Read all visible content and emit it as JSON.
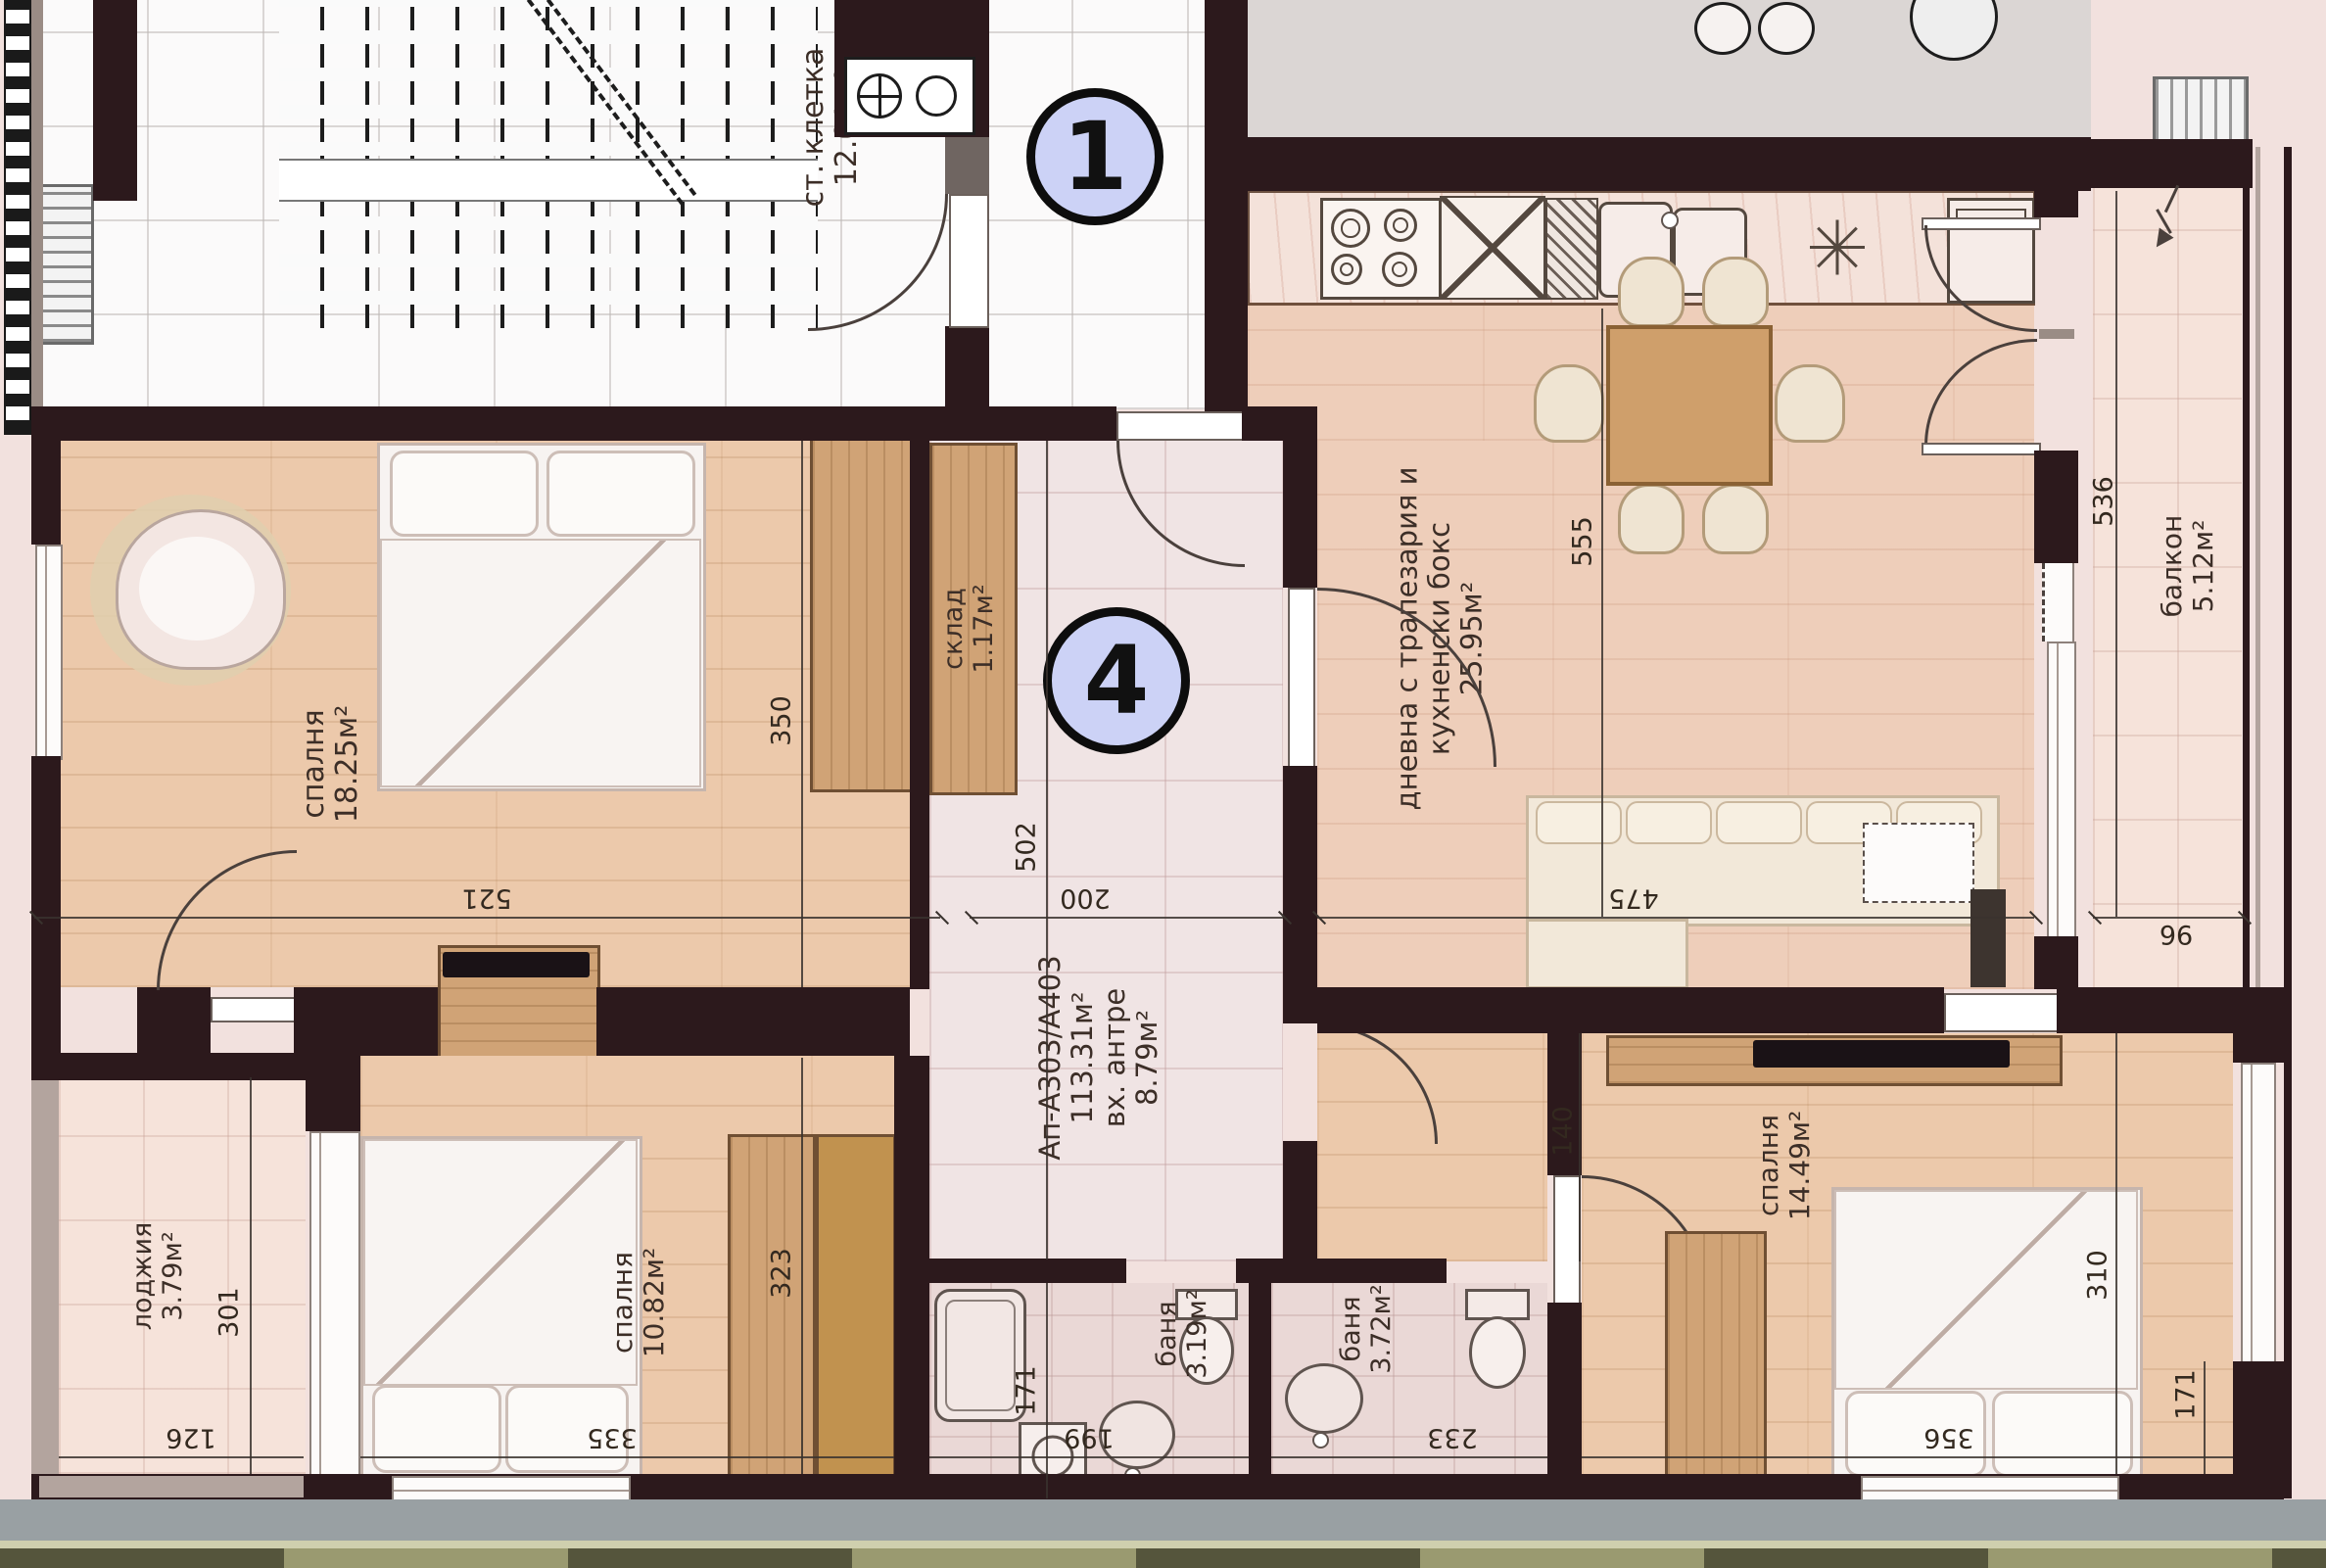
{
  "floorplan": {
    "badges": {
      "stair": "1",
      "apartment": "4"
    },
    "apartment_label": {
      "id": "Ап-А303/А403",
      "total_area": "113.31м²",
      "entry": "вх. антре",
      "entry_area": "8.79м²"
    },
    "rooms": {
      "staircase": {
        "name": "ст. клетка",
        "area": "12.01м²"
      },
      "storage": {
        "name": "склад",
        "area": "1.17м²"
      },
      "living": {
        "name_line1": "дневна с трапезария и",
        "name_line2": "кухненски бокс",
        "area": "25.95м²"
      },
      "bedroom_left": {
        "name": "спалня",
        "area": "18.25м²"
      },
      "bedroom_bottom_left": {
        "name": "спалня",
        "area": "10.82м²"
      },
      "bedroom_bottom_right": {
        "name": "спалня",
        "area": "14.49м²"
      },
      "bath_left": {
        "name": "баня",
        "area": "3.19м²"
      },
      "bath_right": {
        "name": "баня",
        "area": "3.72м²"
      },
      "balcony": {
        "name": "балкон",
        "area": "5.12м²"
      },
      "loggia": {
        "name": "лоджия",
        "area": "3.79м²"
      }
    },
    "dimensions": {
      "bedroom_left_width": "521",
      "hall_width": "200",
      "living_width": "475",
      "balcony_width": "96",
      "wardrobe_depth": "350",
      "hall_length": "502",
      "living_length": "555",
      "balcony_length": "536",
      "loggia_length": "301",
      "loggia_width": "126",
      "bedroom_bl_width": "335",
      "bedroom_bl_length": "323",
      "bath_left_width": "199",
      "bath_left_length": "171",
      "bath_right_width": "233",
      "bedroom_br_width": "356",
      "bedroom_br_length": "310",
      "bedroom_br_niche": "140",
      "bedroom_br_window": "171"
    }
  }
}
